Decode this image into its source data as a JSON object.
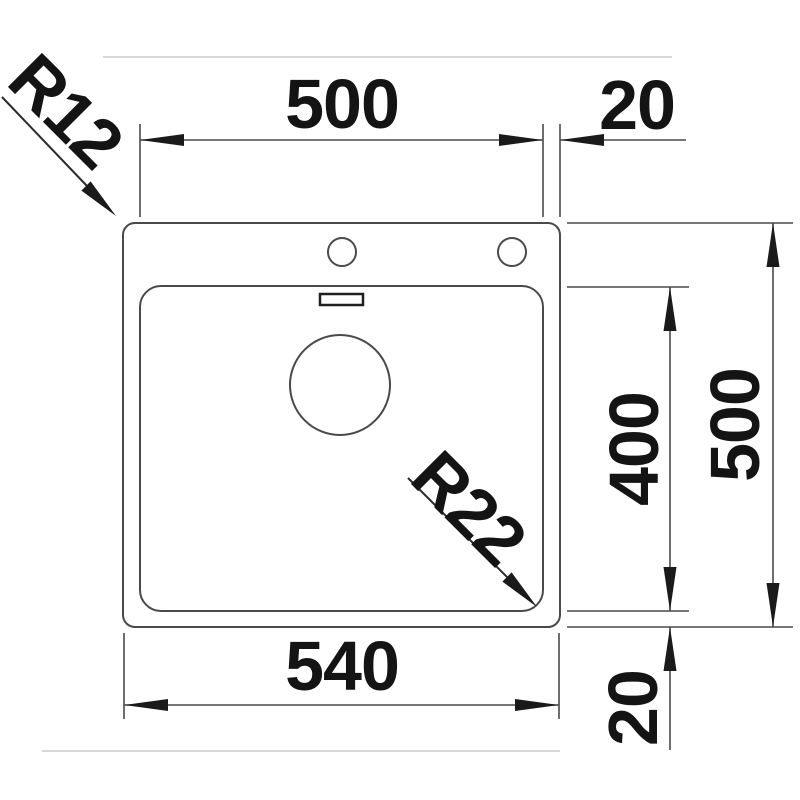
{
  "drawing": {
    "kind": "sink-dimension-drawing",
    "palette": {
      "line": "#4a4a4a",
      "arrow_and_text": "#1a1a1a",
      "faint_guide": "#d9d9d9",
      "background": "#ffffff"
    },
    "labels": {
      "bowl_width_top": "500",
      "rim_offset_top_right": "20",
      "bowl_depth_right": "400",
      "overall_depth_right": "500",
      "overall_width_bottom": "540",
      "rim_offset_bottom_right": "20",
      "outer_corner_radius": "R12",
      "bowl_corner_radius": "R22"
    },
    "features": [
      "outer-rim",
      "bowl",
      "tap-hole-left",
      "tap-hole-right",
      "overflow-slot",
      "drain-hole"
    ]
  }
}
